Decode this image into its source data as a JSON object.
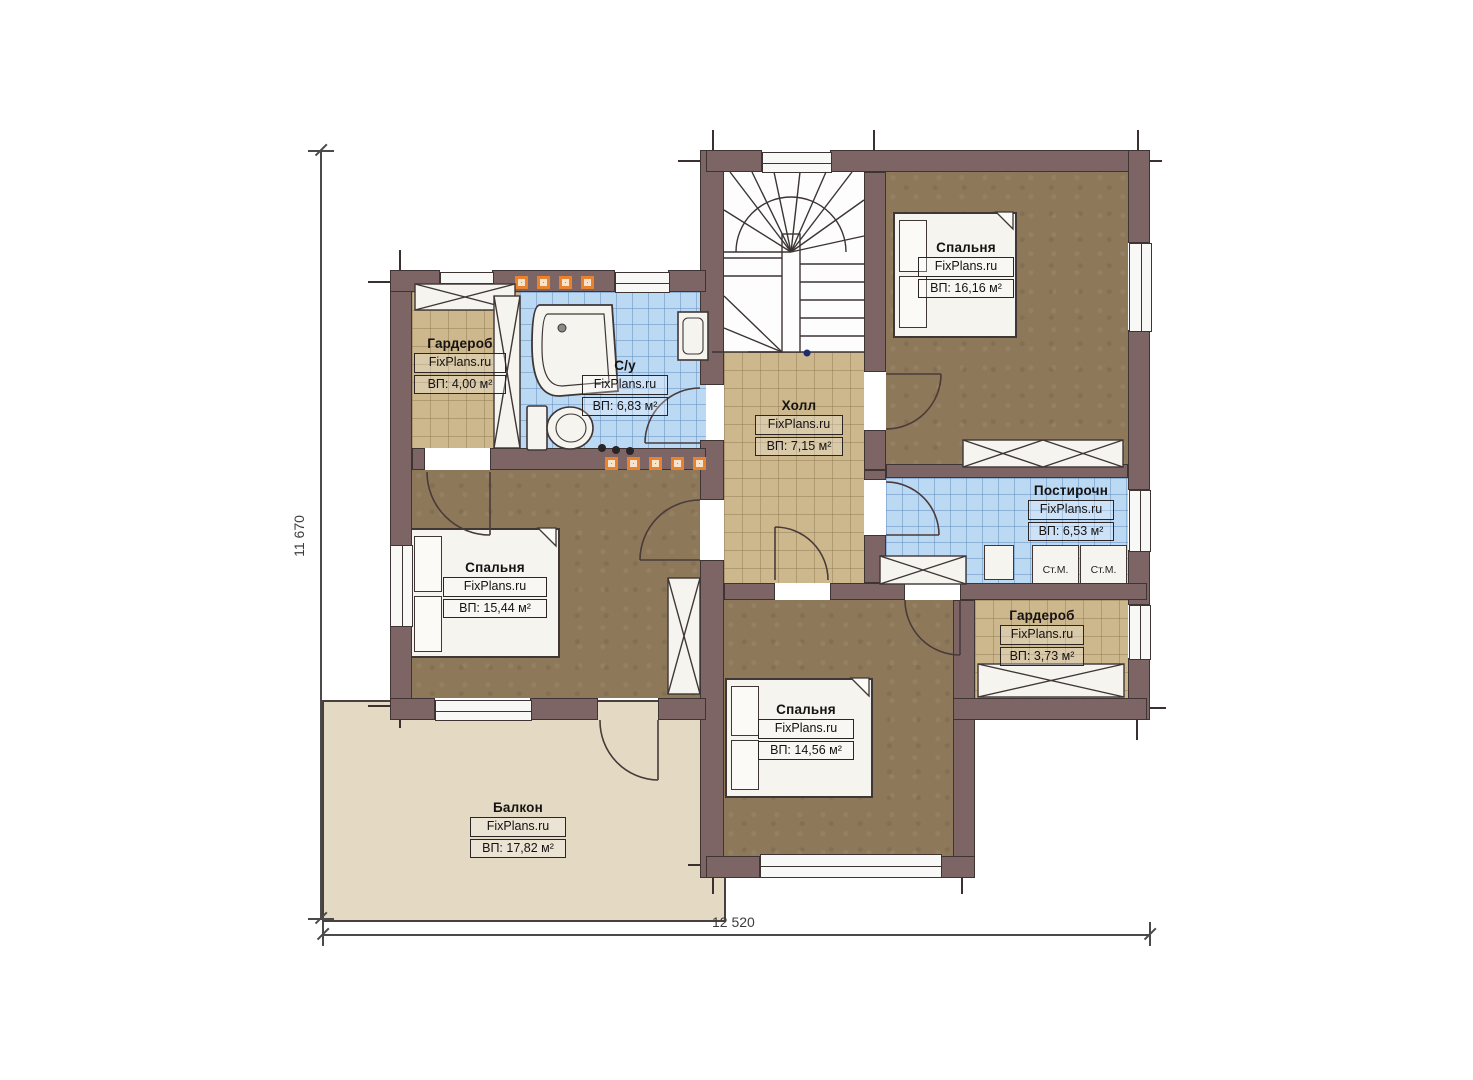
{
  "site_watermark": "FixPlans.ru",
  "dimensions": {
    "height": "11 670",
    "width": "12 520"
  },
  "rooms": [
    {
      "name": "Гардероб",
      "watermark": "FixPlans.ru",
      "area": "ВП: 4,00 м²"
    },
    {
      "name": "С/у",
      "watermark": "FixPlans.ru",
      "area": "ВП: 6,83 м²"
    },
    {
      "name": "Холл",
      "watermark": "FixPlans.ru",
      "area": "ВП: 7,15 м²"
    },
    {
      "name": "Спальня",
      "watermark": "FixPlans.ru",
      "area": "ВП: 16,16 м²"
    },
    {
      "name": "Постирочн",
      "watermark": "FixPlans.ru",
      "area": "ВП: 6,53 м²"
    },
    {
      "name": "Спальня",
      "watermark": "FixPlans.ru",
      "area": "ВП: 15,44 м²"
    },
    {
      "name": "Гардероб",
      "watermark": "FixPlans.ru",
      "area": "ВП: 3,73 м²"
    },
    {
      "name": "Спальня",
      "watermark": "FixPlans.ru",
      "area": "ВП: 14,56 м²"
    },
    {
      "name": "Балкон",
      "watermark": "FixPlans.ru",
      "area": "ВП: 17,82 м²"
    }
  ],
  "appliances": {
    "washer_1": "Ст.М.",
    "washer_2": "Ст.М."
  },
  "colors": {
    "wall": "#7d6565",
    "floor_wood": "#8d795a",
    "tile_tan": "#cdb88d",
    "tile_blue": "#bcd9f4",
    "balcony": "#e4dac4",
    "accent_orange": "#e8822f"
  }
}
